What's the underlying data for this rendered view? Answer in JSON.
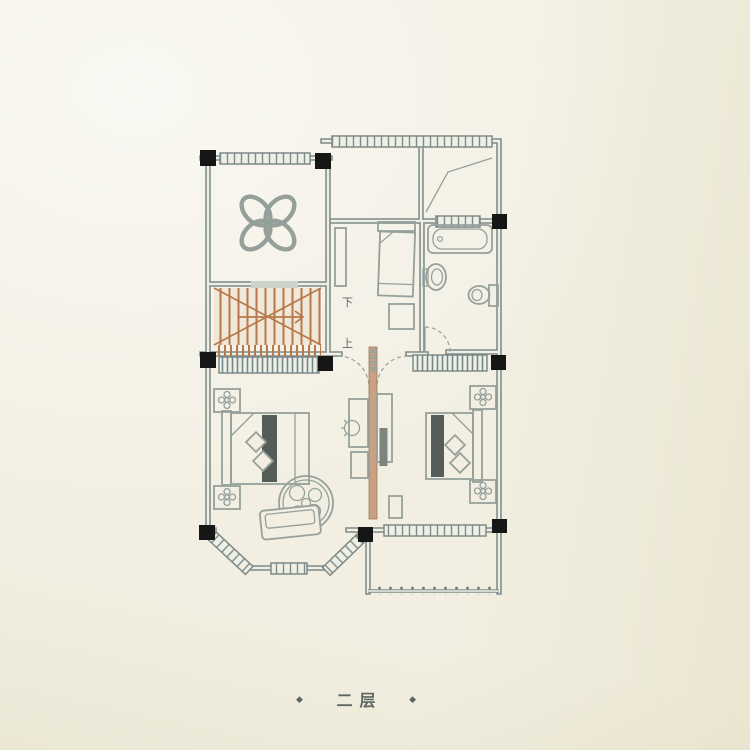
{
  "caption": {
    "left_mark": "◆",
    "text": "二层",
    "right_mark": "◆"
  },
  "stairs": {
    "down_label": "下",
    "up_label": "上"
  },
  "colors": {
    "paper": "#f2efe2",
    "glass": "#eef0e6",
    "wall": "#7e8a88",
    "line": "#96a09b",
    "column": "#161616",
    "stairs": "#b8784a",
    "partition": "#c8a082",
    "bed_stripe": "#565d58",
    "text": "#5d6663"
  }
}
